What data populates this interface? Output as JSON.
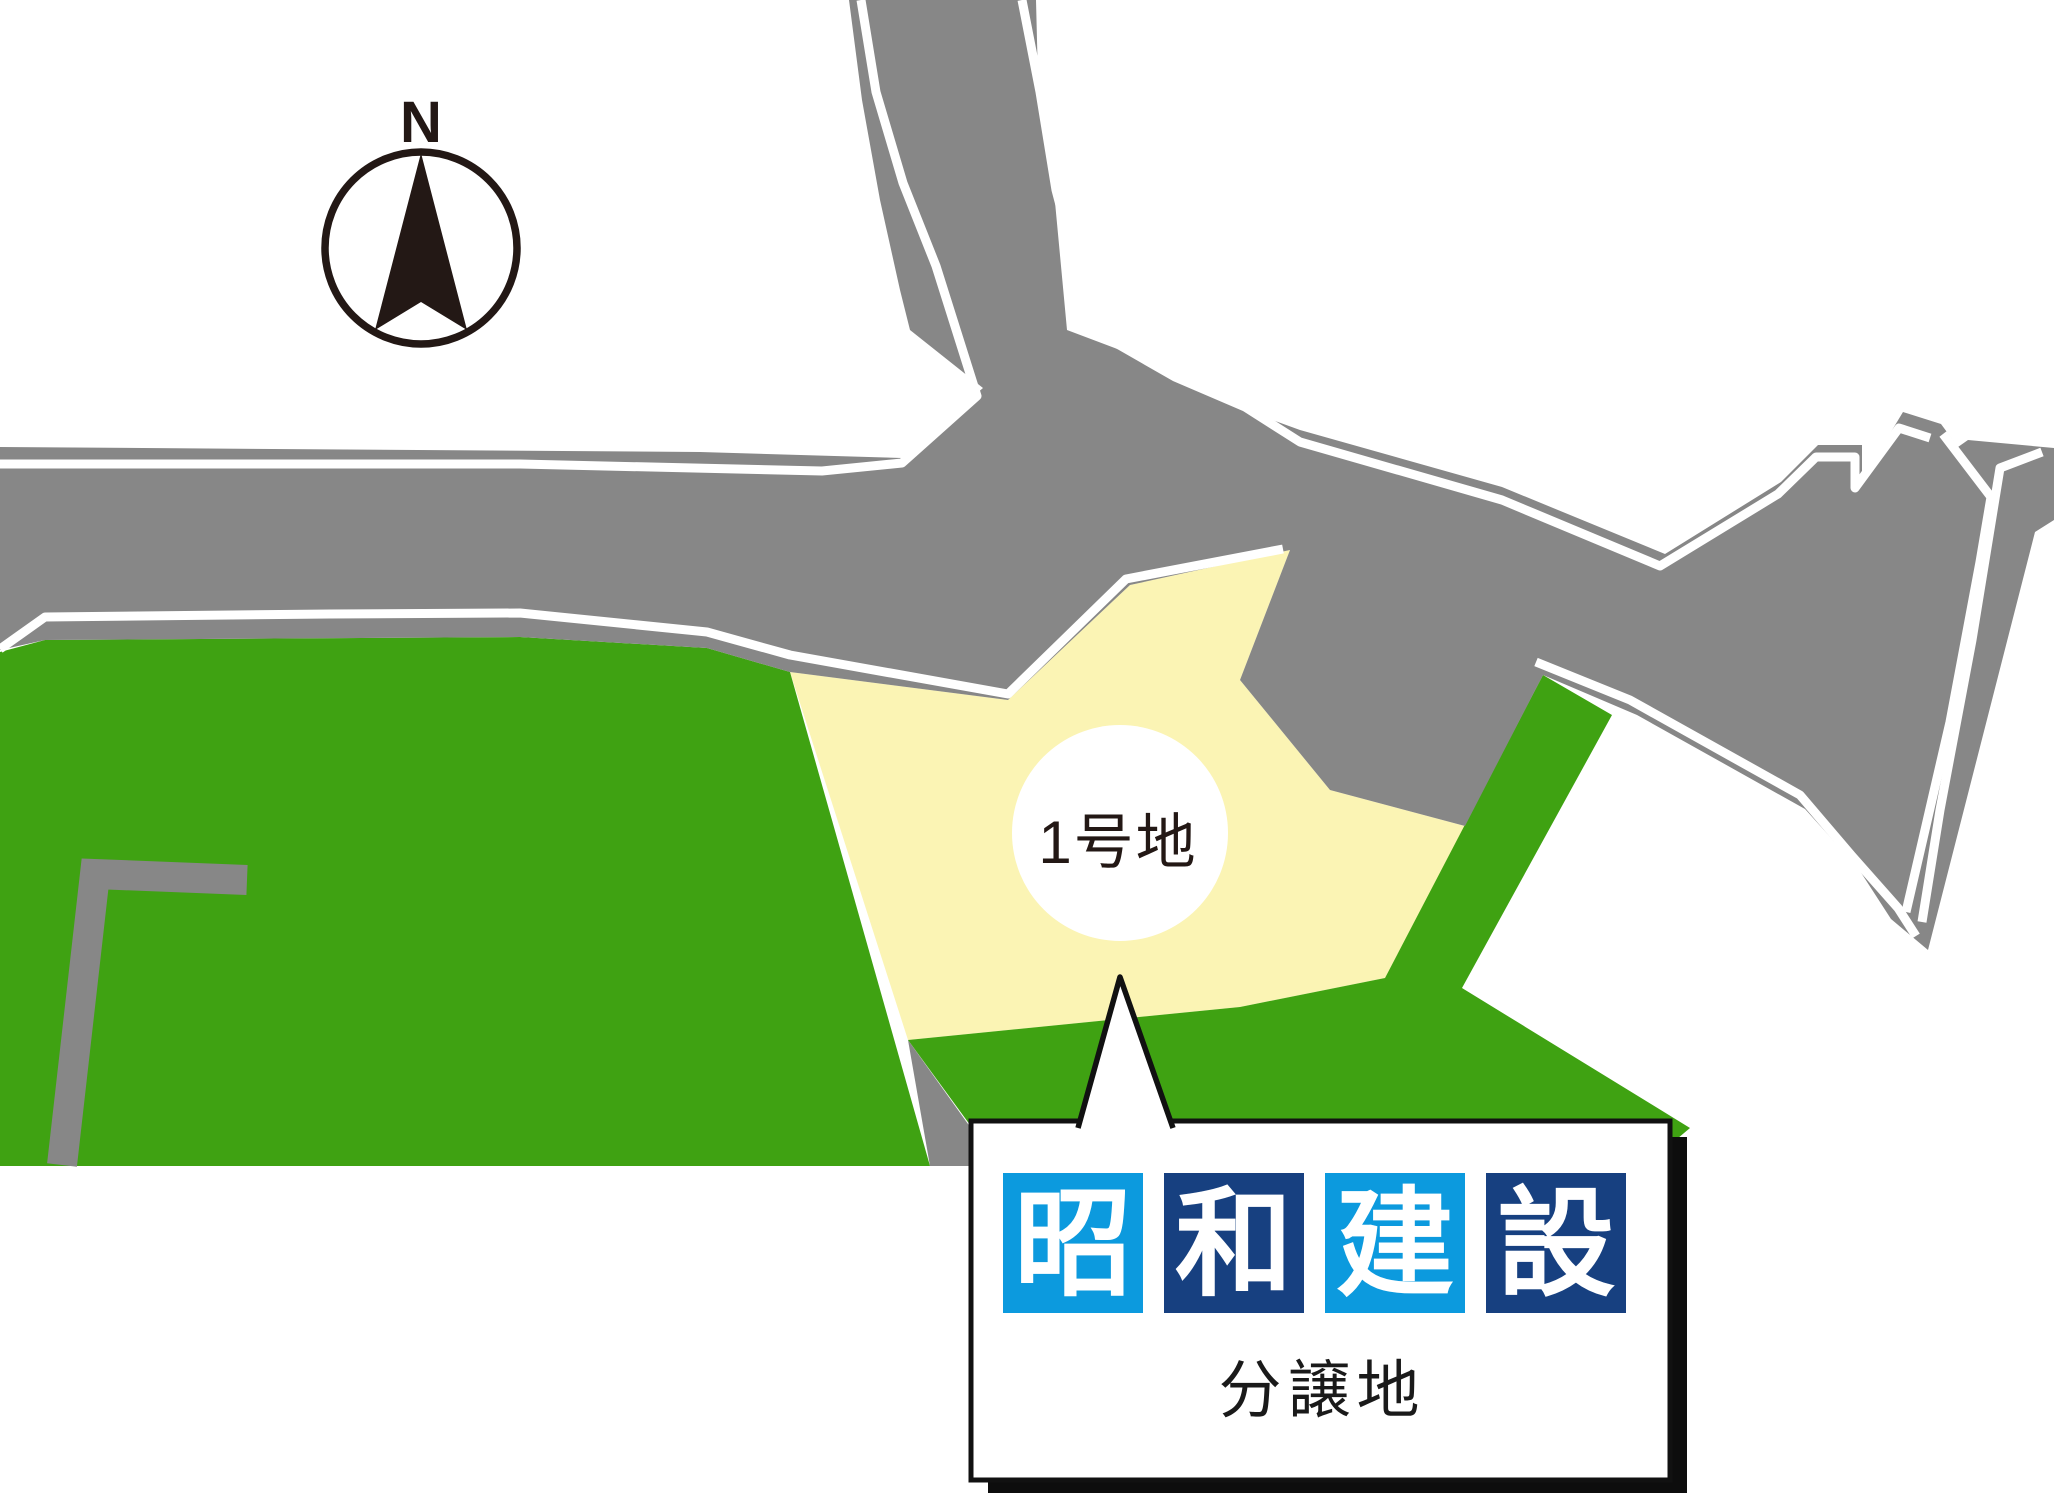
{
  "map": {
    "lot_label": "1号地",
    "compass_label": "N"
  },
  "callout": {
    "company_name": "昭和建設",
    "company_blocks": [
      {
        "char": "昭",
        "bg": "#0c9ade"
      },
      {
        "char": "和",
        "bg": "#174080"
      },
      {
        "char": "建",
        "bg": "#0c9ade"
      },
      {
        "char": "設",
        "bg": "#174080"
      }
    ],
    "caption": "分譲地"
  },
  "colors": {
    "road_gray": "#878787",
    "land_green": "#3fa212",
    "lot_yellow": "#fbf4b4",
    "ink_black": "#231815",
    "logo_light_blue": "#0c9ade",
    "logo_navy": "#174080",
    "callout_bg": "#ffffff",
    "callout_border": "#111111"
  }
}
